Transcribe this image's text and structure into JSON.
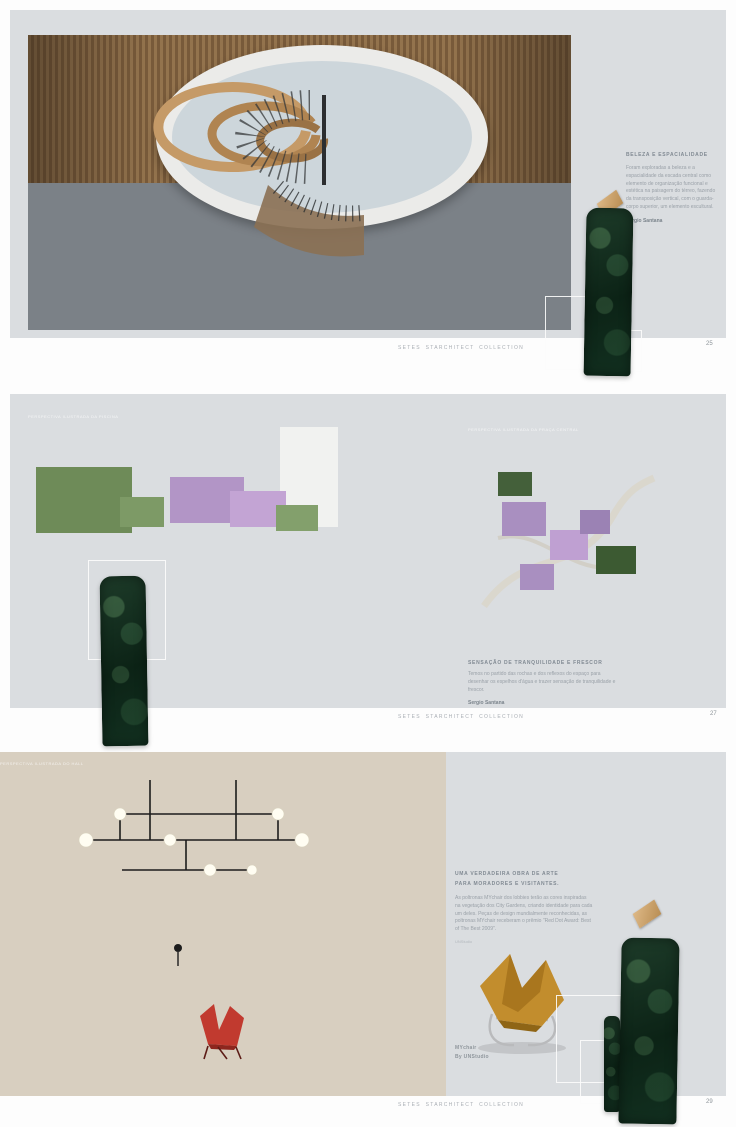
{
  "brand_footer": "SETES STARCHITECT COLLECTION",
  "colors": {
    "page_gray": "#dadde0",
    "deep_green": "#0f2a1c",
    "gold": "#c49a63",
    "text_gray": "#9aa1a8"
  },
  "spread1": {
    "page_number": "25",
    "photo_caption": "PERSPECTIVA ILUSTRADA DO HALL DE ENTRADA",
    "heading": "BELEZA E ESPACIALIDADE",
    "body": "Foram exploradas a beleza e a espacialidade da escada central como elemento de organização funcional e estética na paisagem do térreo, fazendo da transposição vertical, com o guarda-corpo superior, um elemento escultural.",
    "signature": "Sergio Santana"
  },
  "spread2": {
    "page_number": "27",
    "photo_left_caption": "PERSPECTIVA ILUSTRADA DA PISCINA",
    "photo_right_caption": "PERSPECTIVA ILUSTRADA DA PRAÇA CENTRAL",
    "heading": "SENSAÇÃO DE TRANQUILIDADE E FRESCOR",
    "body": "Temos no partido das rochas e dos reflexos do espaço para desenhar os espelhos d'água e trazer sensação de tranquilidade e frescor.",
    "signature": "Sergio Santana"
  },
  "spread3": {
    "page_number": "29",
    "photo_caption": "PERSPECTIVA ILUSTRADA DO HALL",
    "heading_line1": "UMA VERDADEIRA OBRA DE ARTE",
    "heading_line2": "PARA MORADORES E VISITANTES.",
    "body": "As poltronas MYchair dos lobbies terão as cores inspiradas na vegetação dos City Gardens, criando identidade para cada um deles. Peças de design mundialmente reconhecidas, as poltronas MYchair receberam o prêmio \"Red Dot Award: Best of The Best 2009\".",
    "credit": "UNStudio",
    "product_name": "MYchair",
    "product_designer": "By UNStudio"
  }
}
